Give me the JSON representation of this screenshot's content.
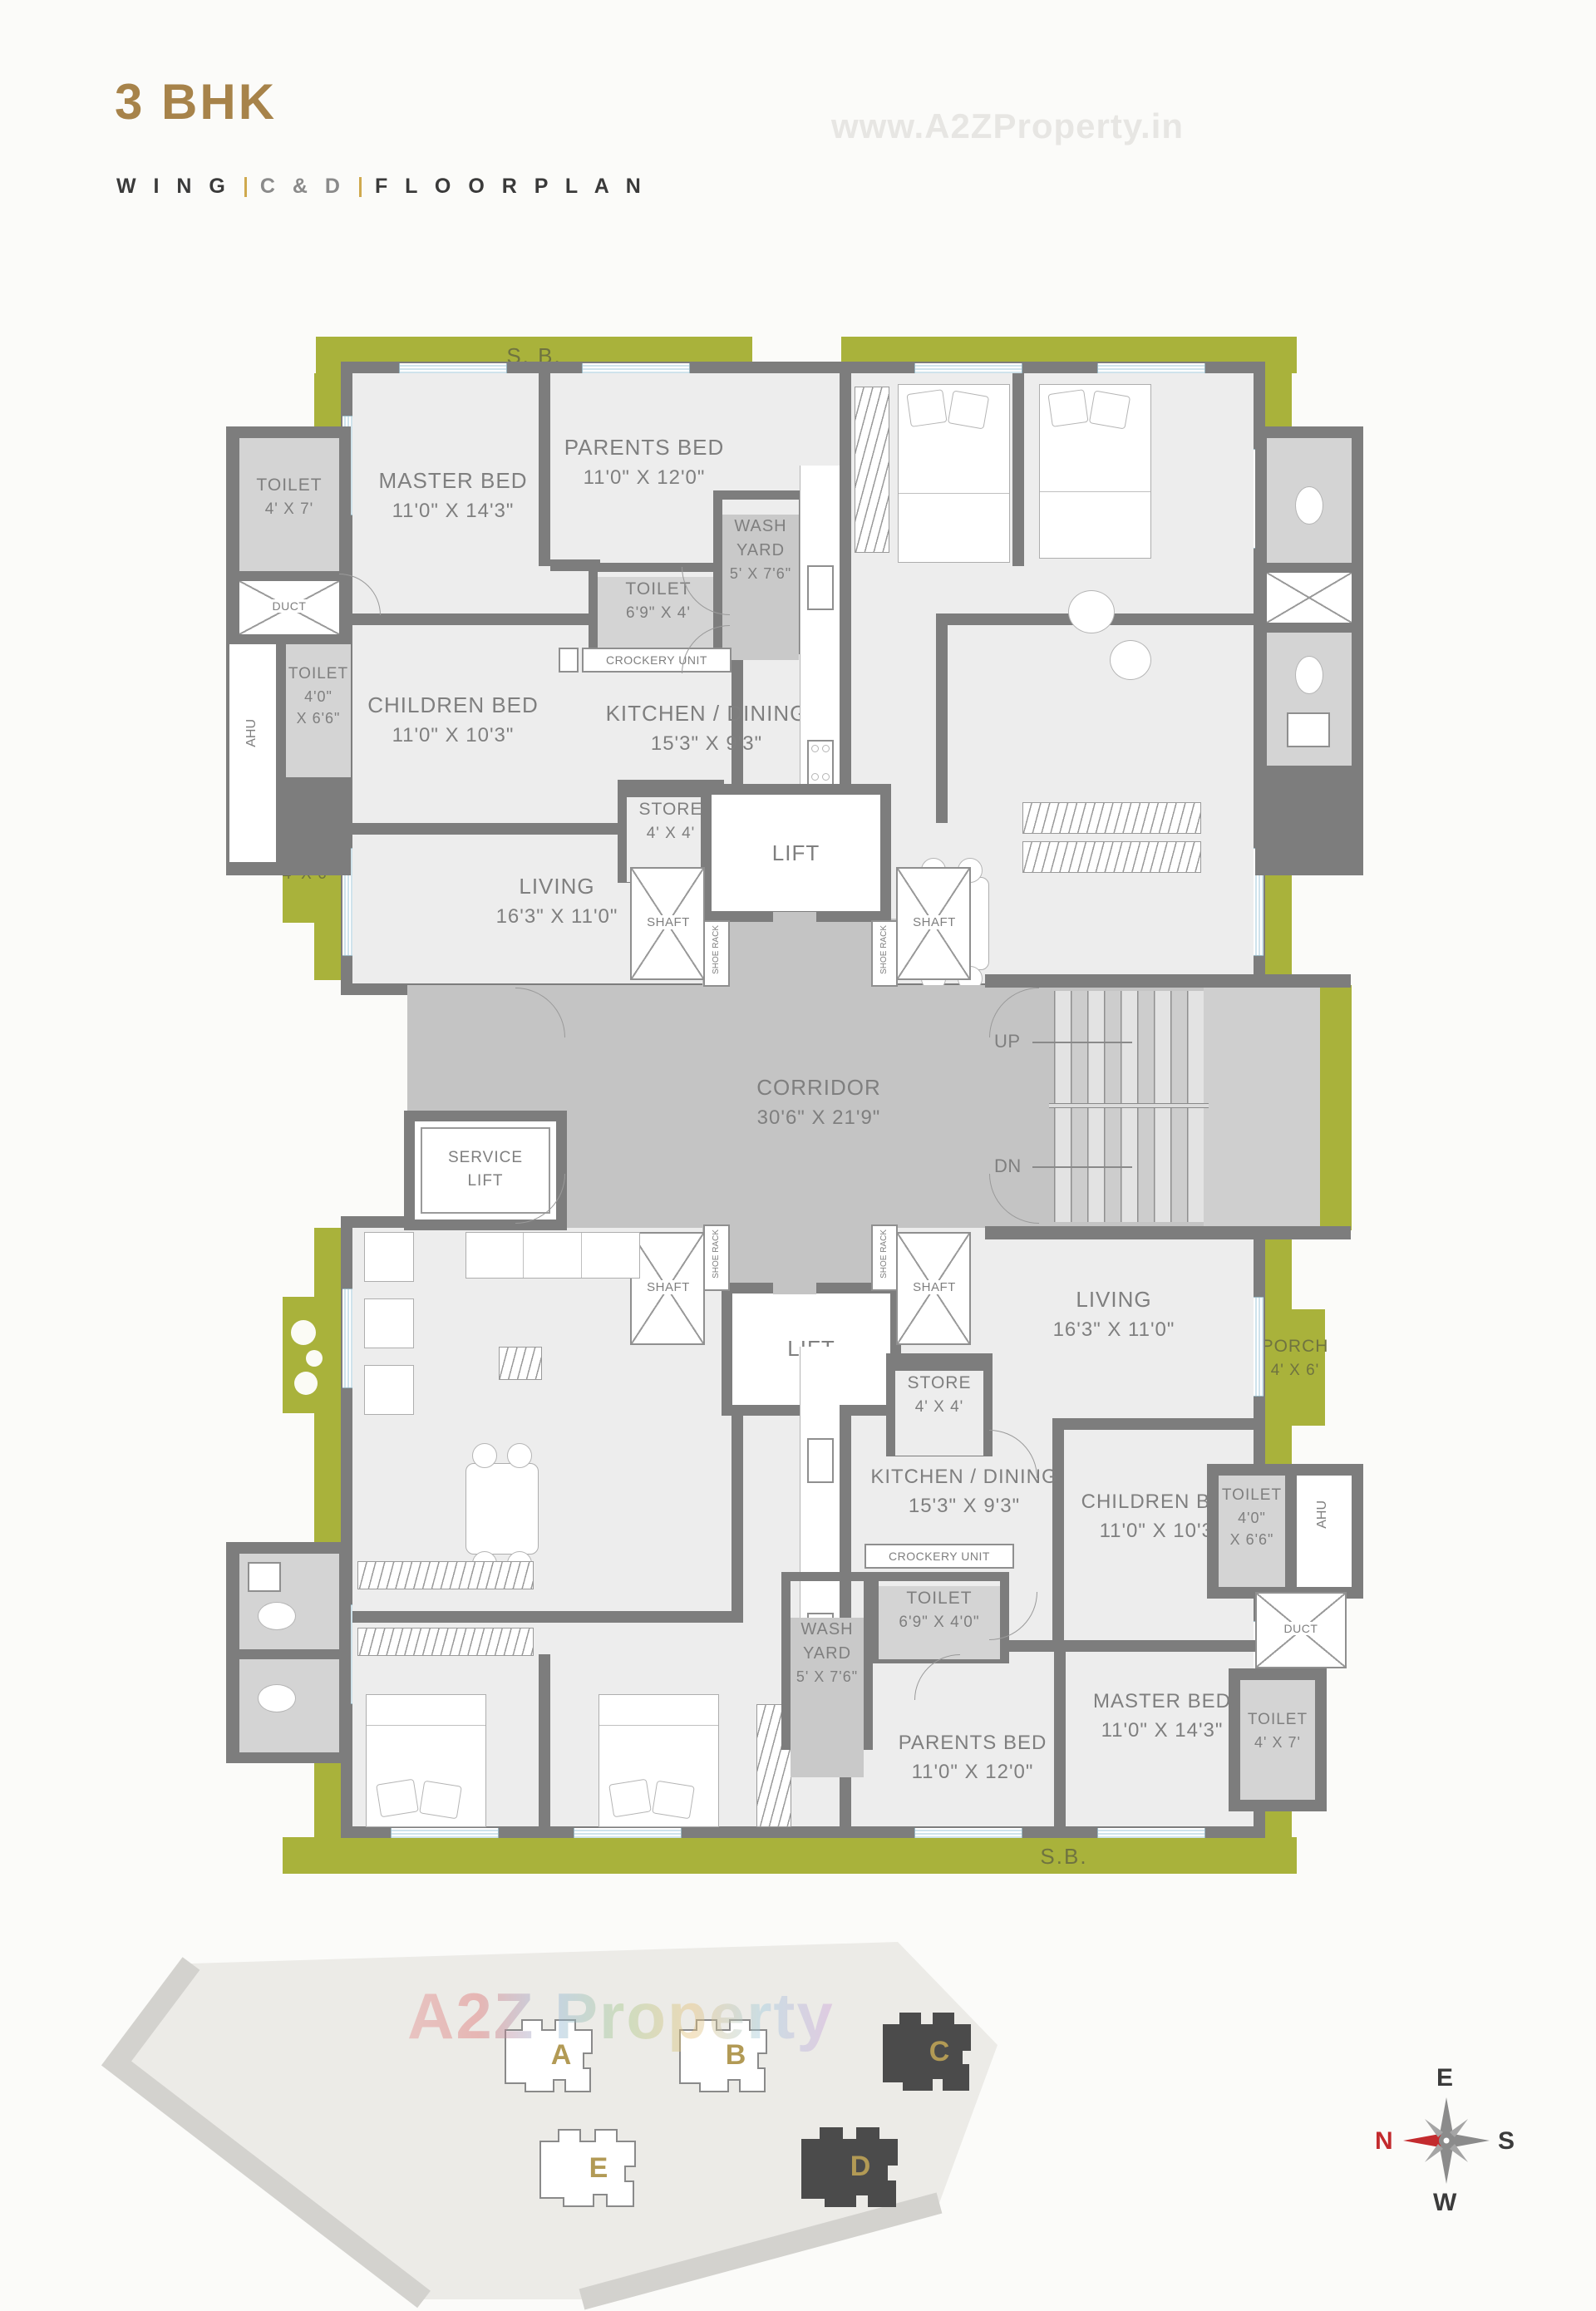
{
  "header": {
    "title": "3 BHK",
    "subtitle": {
      "wing": "W I N G",
      "wings": "C & D",
      "plan": "F L O O R P L A N"
    },
    "watermark_top": "www.A2ZProperty.in"
  },
  "colors": {
    "accent_gold": "#a7834a",
    "balcony_green": "#a9b23b",
    "wall_gray": "#7d7d7d",
    "floor_gray": "#ededed",
    "corridor_gray": "#c4c4c4",
    "toilet_gray": "#d4d4d4",
    "label_gray": "#7f7f7f",
    "dark_wing_fill": "#4b4b4b",
    "compass_red": "#c32b2e"
  },
  "unit_c": {
    "sb": "S. B.",
    "toilet_top": {
      "name": "TOILET",
      "dims": "4' X 7'"
    },
    "master": {
      "name": "MASTER BED",
      "dims": "11'0\" X 14'3\""
    },
    "parents": {
      "name": "PARENTS BED",
      "dims": "11'0\" X 12'0\""
    },
    "duct": "DUCT",
    "ahu": "AHU",
    "toilet_left": {
      "name": "TOILET",
      "dims1": "4'0\"",
      "dims2": "X 6'6\""
    },
    "children": {
      "name": "CHILDREN BED",
      "dims": "11'0\" X 10'3\""
    },
    "toilet_mid": {
      "name": "TOILET",
      "dims": "6'9\" X 4'"
    },
    "crockery": "CROCKERY UNIT",
    "kitchen": {
      "name": "KITCHEN / DINING",
      "dims": "15'3\" X 9'3\""
    },
    "wash": {
      "l1": "WASH",
      "l2": "YARD",
      "l3": "5' X 7'6\""
    },
    "store": {
      "name": "STORE",
      "dims": "4' X 4'"
    },
    "living": {
      "name": "LIVING",
      "dims": "16'3\" X 11'0\""
    },
    "porch": {
      "name": "PORCH",
      "dims": "4' X 6'"
    }
  },
  "unit_d": {
    "sb": "S.B.",
    "toilet_top": {
      "name": "TOILET",
      "dims": "4' X 7'"
    },
    "master": {
      "name": "MASTER BED",
      "dims": "11'0\" X 14'3\""
    },
    "parents": {
      "name": "PARENTS BED",
      "dims": "11'0\" X 12'0\""
    },
    "duct": "DUCT",
    "ahu": "AHU",
    "toilet_left": {
      "name": "TOILET",
      "dims1": "4'0\"",
      "dims2": "X 6'6\""
    },
    "children": {
      "name": "CHILDREN BED",
      "dims": "11'0\" X 10'3\""
    },
    "toilet_mid": {
      "name": "TOILET",
      "dims": "6'9\" X 4'0\""
    },
    "crockery": "CROCKERY UNIT",
    "kitchen": {
      "name": "KITCHEN / DINING",
      "dims": "15'3\" X 9'3\""
    },
    "wash": {
      "l1": "WASH",
      "l2": "YARD",
      "l3": "5' X 7'6\""
    },
    "store": {
      "name": "STORE",
      "dims": "4' X 4'"
    },
    "living": {
      "name": "LIVING",
      "dims": "16'3\" X 11'0\""
    },
    "porch": {
      "name": "PORCH",
      "dims": "4' X 6'"
    }
  },
  "core": {
    "lift": "LIFT",
    "service_lift_line1": "SERVICE",
    "service_lift_line2": "LIFT",
    "shaft": "SHAFT",
    "shoe_rack": "SHOE RACK",
    "corridor": {
      "name": "CORRIDOR",
      "dims": "30'6\" X 21'9\""
    },
    "up": "UP",
    "dn": "DN"
  },
  "key_plan": {
    "a": "A",
    "b": "B",
    "c": "C",
    "d": "D",
    "e": "E",
    "watermark": "A2Z Property"
  },
  "compass": {
    "top": "E",
    "right": "S",
    "bottom": "W",
    "left": "N"
  }
}
